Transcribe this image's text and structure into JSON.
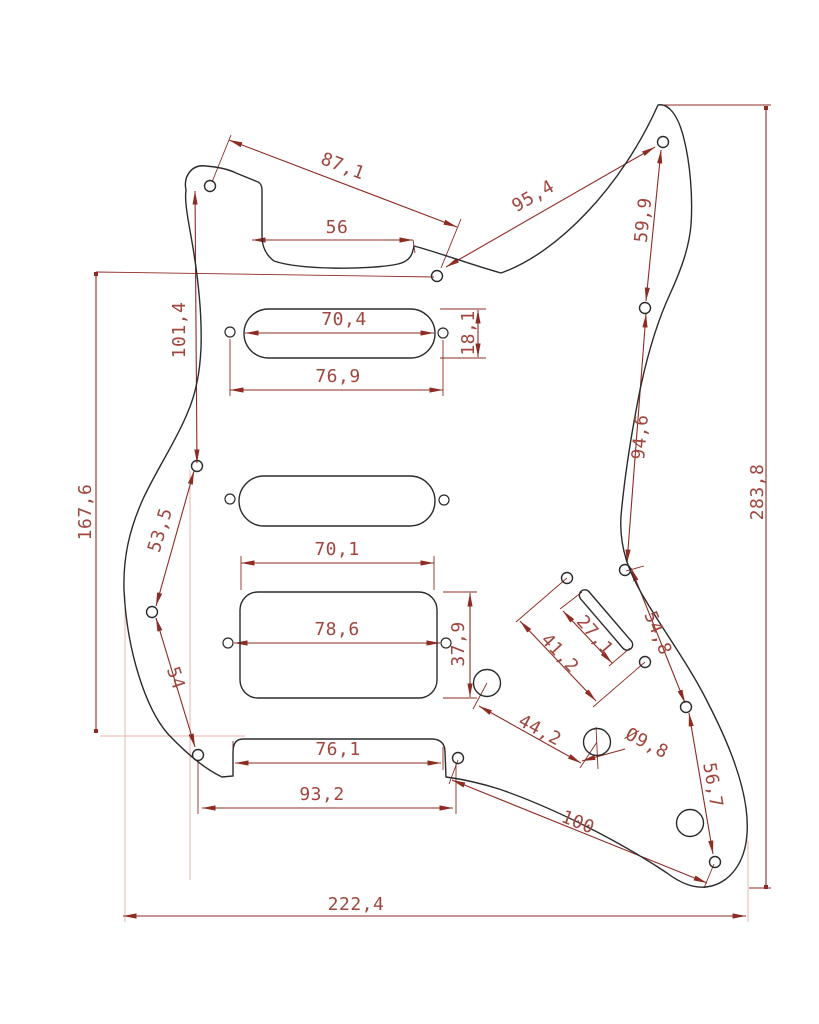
{
  "drawing": {
    "type": "technical-dimension-drawing",
    "subject": "Stratocaster HSS pickguard with screw holes, pickup cutouts, selector-switch slot and potentiometer holes",
    "background_color": "#ffffff",
    "outline_color": "#2b2b2b",
    "dimension_line_color": "#8e2b22",
    "dimension_text_color": "#a0463e",
    "aux_line_color": "#eab3ab",
    "decimal_separator": ",",
    "diameter_symbol": "Ø",
    "dimensions": [
      {
        "id": "87-1",
        "label": "87,1",
        "x": 343,
        "y": 166,
        "rot": 21
      },
      {
        "id": "56",
        "label": "56",
        "x": 337,
        "y": 227,
        "rot": 0
      },
      {
        "id": "95-4",
        "label": "95,4",
        "x": 533,
        "y": 196,
        "rot": -30
      },
      {
        "id": "59-9",
        "label": "59,9",
        "x": 643,
        "y": 220,
        "rot": -84
      },
      {
        "id": "101-4",
        "label": "101,4",
        "x": 179,
        "y": 330,
        "rot": -90
      },
      {
        "id": "167-6",
        "label": "167,6",
        "x": 85,
        "y": 512,
        "rot": -90
      },
      {
        "id": "70-4",
        "label": "70,4",
        "x": 344,
        "y": 319,
        "rot": 0
      },
      {
        "id": "18-1",
        "label": "18,1",
        "x": 468,
        "y": 333,
        "rot": -90
      },
      {
        "id": "76-9",
        "label": "76,9",
        "x": 338,
        "y": 376,
        "rot": 0
      },
      {
        "id": "53-5",
        "label": "53,5",
        "x": 160,
        "y": 530,
        "rot": -73
      },
      {
        "id": "54",
        "label": "54",
        "x": 176,
        "y": 678,
        "rot": 72
      },
      {
        "id": "70-1",
        "label": "70,1",
        "x": 337,
        "y": 549,
        "rot": 0
      },
      {
        "id": "78-6",
        "label": "78,6",
        "x": 337,
        "y": 629,
        "rot": 0
      },
      {
        "id": "37-9",
        "label": "37,9",
        "x": 458,
        "y": 644,
        "rot": -90
      },
      {
        "id": "27-1",
        "label": "27,1",
        "x": 595,
        "y": 635,
        "rot": 49
      },
      {
        "id": "41-2",
        "label": "41,2",
        "x": 560,
        "y": 653,
        "rot": 47
      },
      {
        "id": "94-6",
        "label": "94,6",
        "x": 640,
        "y": 437,
        "rot": -85
      },
      {
        "id": "54-8",
        "label": "54,8",
        "x": 658,
        "y": 633,
        "rot": 68
      },
      {
        "id": "44-2",
        "label": "44,2",
        "x": 540,
        "y": 730,
        "rot": 28
      },
      {
        "id": "dia-9-8",
        "label": "Ø9,8",
        "x": 647,
        "y": 743,
        "rot": 27
      },
      {
        "id": "100",
        "label": "100",
        "x": 578,
        "y": 822,
        "rot": 22
      },
      {
        "id": "56-7",
        "label": "56,7",
        "x": 713,
        "y": 785,
        "rot": 80
      },
      {
        "id": "76-1",
        "label": "76,1",
        "x": 338,
        "y": 749,
        "rot": 0
      },
      {
        "id": "93-2",
        "label": "93,2",
        "x": 322,
        "y": 794,
        "rot": 0
      },
      {
        "id": "222-4",
        "label": "222,4",
        "x": 356,
        "y": 904,
        "rot": 0
      },
      {
        "id": "283-8",
        "label": "283,8",
        "x": 757,
        "y": 492,
        "rot": -90
      }
    ]
  }
}
